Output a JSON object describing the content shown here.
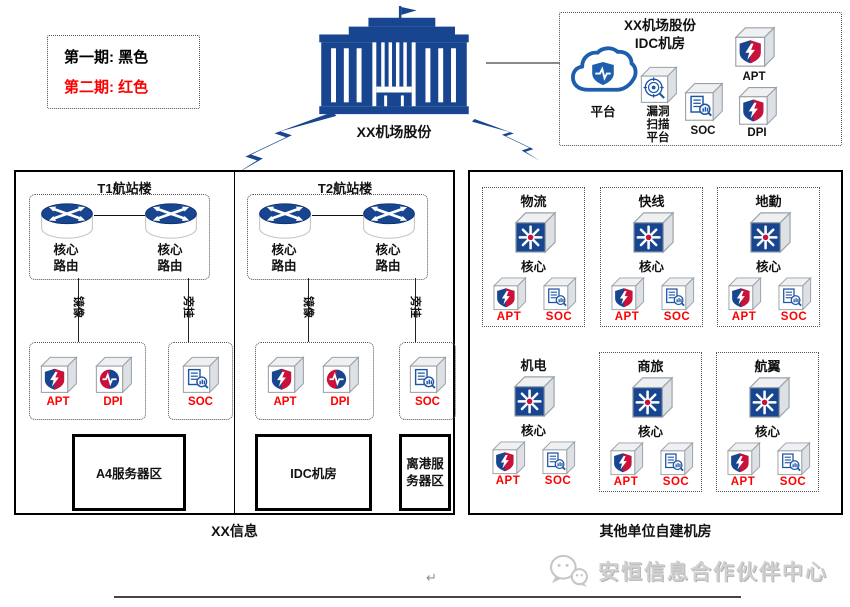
{
  "colors": {
    "primary_blue": "#17458f",
    "red_label": "#ff0000",
    "shield_red": "#c9113a",
    "cloud_blue": "#1d5fad",
    "connector_gray": "#8a8a8a",
    "watermark_gray": "#d0d0d0"
  },
  "legend": {
    "line1": "第一期: 黑色",
    "line2": "第二期: 红色"
  },
  "hq": {
    "label": "XX机场股份"
  },
  "idc": {
    "title": "XX机场股份\nIDC机房",
    "cloud_label": "平台",
    "scan_label": "漏洞\n扫描\n平台",
    "soc_label": "SOC",
    "apt_label": "APT",
    "dpi_label": "DPI"
  },
  "left_zone": {
    "caption": "XX信息",
    "t1": {
      "title": "T1航站楼",
      "router1": "核心\n路由",
      "router2": "核心\n路由",
      "link1": "镜像",
      "link2": "旁挂",
      "apt": "APT",
      "dpi": "DPI",
      "soc": "SOC",
      "server": "A4服务器区"
    },
    "t2": {
      "title": "T2航站楼",
      "router1": "核心\n路由",
      "router2": "核心\n路由",
      "link1": "镜像",
      "link2": "旁挂",
      "apt": "APT",
      "dpi": "DPI",
      "soc": "SOC",
      "server": "IDC机房",
      "server2": "离港服\n务器区"
    }
  },
  "right_zone": {
    "caption": "其他单位自建机房",
    "sections": [
      {
        "title": "物流",
        "core": "核心",
        "apt": "APT",
        "soc": "SOC"
      },
      {
        "title": "快线",
        "core": "核心",
        "apt": "APT",
        "soc": "SOC"
      },
      {
        "title": "地勤",
        "core": "核心",
        "apt": "APT",
        "soc": "SOC"
      },
      {
        "title": "机电",
        "core": "核心",
        "apt": "APT",
        "soc": "SOC"
      },
      {
        "title": "商旅",
        "core": "核心",
        "apt": "APT",
        "soc": "SOC"
      },
      {
        "title": "航翼",
        "core": "核心",
        "apt": "APT",
        "soc": "SOC"
      }
    ]
  },
  "footer": {
    "pilcrow": "↵",
    "brand": "安恒信息合作伙伴中心"
  }
}
